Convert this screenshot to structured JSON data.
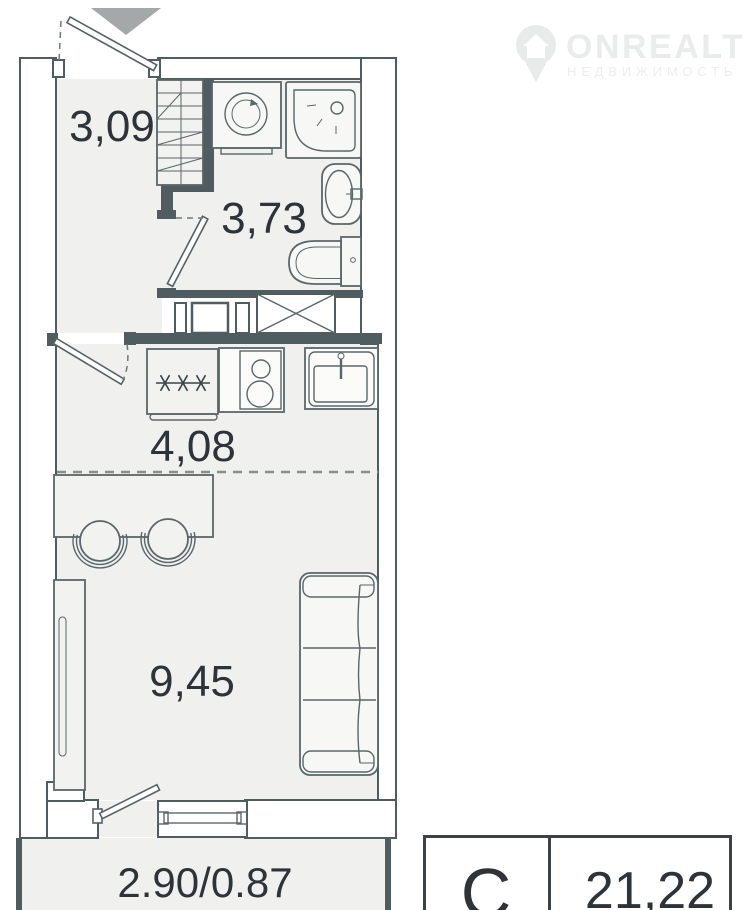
{
  "watermark": {
    "brand": "ONREALT",
    "tagline": "НЕДВИЖИМОСТЬ",
    "logo_icon": "map-pin-house-icon",
    "color": "#eaecec"
  },
  "plan": {
    "entrance_marker_icon": "down-arrow-icon",
    "rooms": {
      "hallway": {
        "area": "3,09"
      },
      "bathroom": {
        "area": "3,73"
      },
      "kitchen": {
        "area": "4,08"
      },
      "living": {
        "area": "9,45"
      },
      "balcony": {
        "area": "2.90/0.87"
      }
    },
    "fixture_icons": [
      "shelving-unit-icon",
      "washing-machine-icon",
      "shower-icon",
      "wash-basin-icon",
      "toilet-icon",
      "ventilation-shaft-icon",
      "refrigerator-icon",
      "stove-icon",
      "kitchen-sink-icon",
      "dining-table-icon",
      "chair-icon",
      "wardrobe-icon",
      "sofa-icon",
      "window-icon",
      "door-swing-icon"
    ],
    "colors": {
      "wall": "#4f5d60",
      "floor": "#f0f0ee",
      "entrance_arrow": "#a4a8a9",
      "label_text": "#2d3339"
    }
  },
  "legend": {
    "type_label": "С",
    "area_value": "21,22"
  }
}
